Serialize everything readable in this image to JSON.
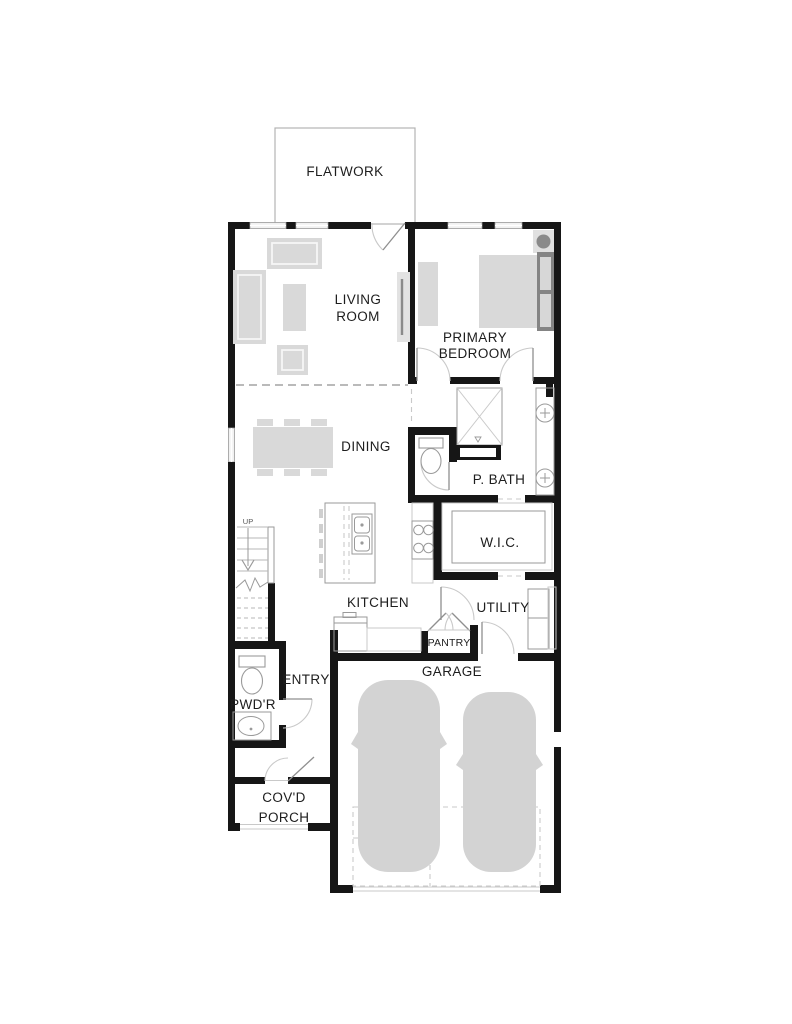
{
  "title": "Floor plan",
  "colors": {
    "wall": "#161616",
    "furn": "#d9d9d9",
    "furn-dark": "#848484",
    "line": "#9a9a9a",
    "line-light": "#c9c9c9",
    "bg": "#ffffff",
    "ink": "#1d1d1d"
  },
  "rooms": {
    "flatwork": {
      "label": "FLATWORK"
    },
    "living_room": {
      "label_line1": "LIVING",
      "label_line2": "ROOM"
    },
    "primary_bedroom": {
      "label_line1": "PRIMARY",
      "label_line2": "BEDROOM"
    },
    "dining": {
      "label": "DINING"
    },
    "p_bath": {
      "label": "P. BATH"
    },
    "wic": {
      "label": "W.I.C."
    },
    "kitchen": {
      "label": "KITCHEN"
    },
    "utility": {
      "label": "UTILITY"
    },
    "pantry": {
      "label": "PANTRY"
    },
    "entry": {
      "label": "ENTRY"
    },
    "powder": {
      "label": "PWD'R"
    },
    "covered_porch": {
      "label_line1": "COV'D",
      "label_line2": "PORCH"
    },
    "garage": {
      "label": "GARAGE"
    }
  },
  "stairs": {
    "direction_label": "UP"
  }
}
